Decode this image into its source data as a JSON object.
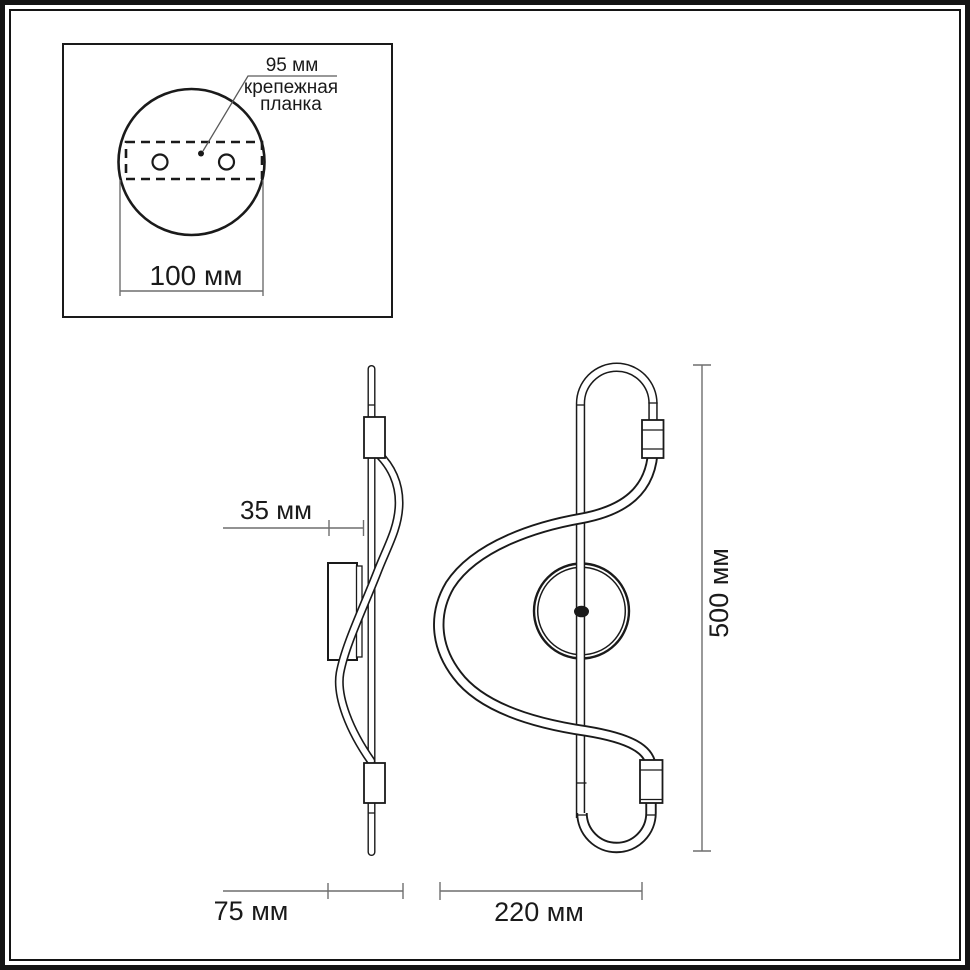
{
  "colors": {
    "ink": "#1a1a1a",
    "dimension_line": "#6e6e6e",
    "background": "#ffffff",
    "frame": "#141414"
  },
  "mount_detail_inset": {
    "hole_spacing_label": "95 мм",
    "bracket_label_line1": "крепежная",
    "bracket_label_line2": "планка",
    "plate_width_label": "100 мм"
  },
  "side_view": {
    "wall_offset_label": "35 мм",
    "depth_label": "75 мм"
  },
  "front_view": {
    "width_label": "220 мм",
    "height_label": "500 мм"
  }
}
